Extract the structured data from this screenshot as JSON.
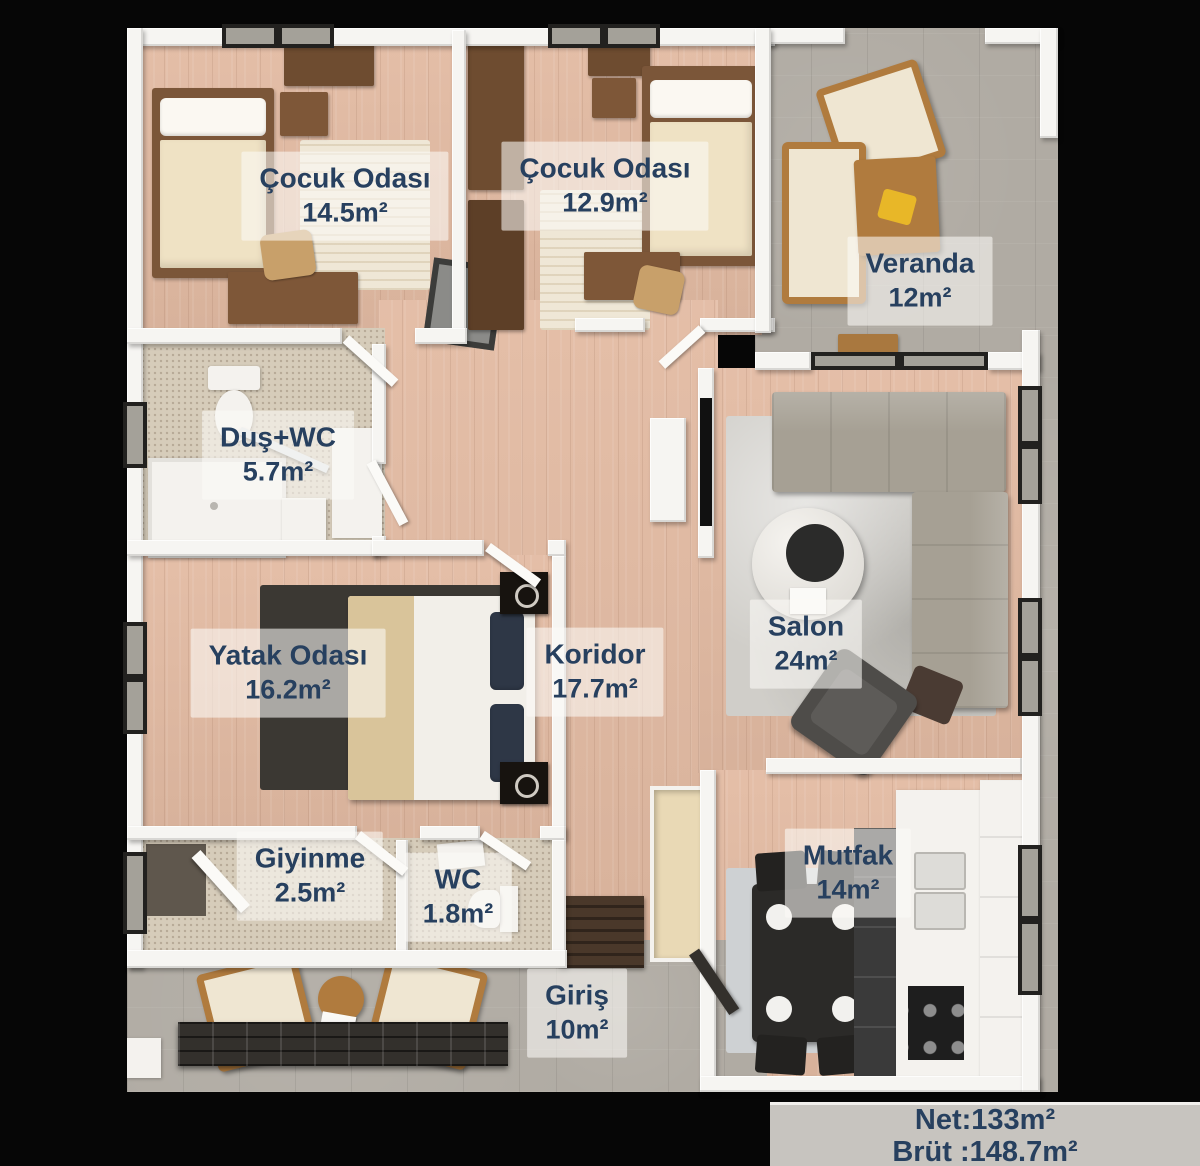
{
  "rooms": [
    {
      "id": "cocuk-odasi-1",
      "name": "Çocuk Odası",
      "area": "14.5m²"
    },
    {
      "id": "cocuk-odasi-2",
      "name": "Çocuk Odası",
      "area": "12.9m²"
    },
    {
      "id": "veranda",
      "name": "Veranda",
      "area": "12m²"
    },
    {
      "id": "dus-wc",
      "name": "Duş+WC",
      "area": "5.7m²"
    },
    {
      "id": "yatak-odasi",
      "name": "Yatak Odası",
      "area": "16.2m²"
    },
    {
      "id": "koridor",
      "name": "Koridor",
      "area": "17.7m²"
    },
    {
      "id": "salon",
      "name": "Salon",
      "area": "24m²"
    },
    {
      "id": "giyinme",
      "name": "Giyinme",
      "area": "2.5m²"
    },
    {
      "id": "wc",
      "name": "WC",
      "area": "1.8m²"
    },
    {
      "id": "giris",
      "name": "Giriş",
      "area": "10m²"
    },
    {
      "id": "mutfak",
      "name": "Mutfak",
      "area": "14m²"
    }
  ],
  "summary": {
    "net": "Net:133m²",
    "brut": "Brüt :148.7m²"
  },
  "colors": {
    "label_text": "#27405f",
    "label_bg": "rgba(252,250,246,0.58)",
    "wall": "#f6f5f2",
    "wood": "#e3bba3",
    "concrete": "#b0aba3",
    "tile": "#d6ccba",
    "background": "#060606",
    "summary_bg": "#c7c4bf"
  }
}
